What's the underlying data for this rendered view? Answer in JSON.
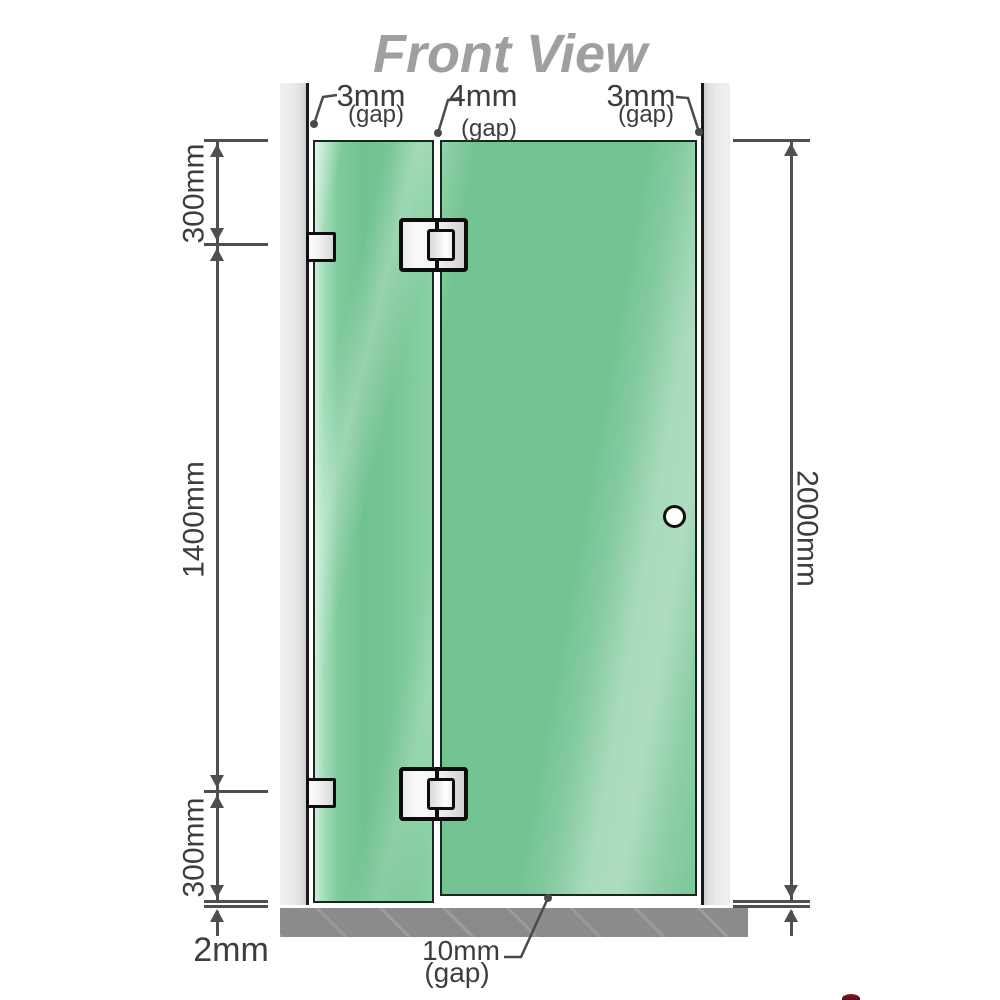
{
  "title": "Front View",
  "dimensions": {
    "gap_left": {
      "value": "3mm",
      "suffix": "(gap)"
    },
    "gap_mid": {
      "value": "4mm",
      "suffix": "(gap)"
    },
    "gap_right": {
      "value": "3mm",
      "suffix": "(gap)"
    },
    "seg_top": "300mm",
    "seg_mid": "1400mm",
    "seg_bottom": "300mm",
    "overall": "2000mm",
    "floor_clearance": "2mm",
    "bottom_gap": {
      "value": "10mm",
      "suffix": "(gap)"
    }
  },
  "colors": {
    "glass": "#74c493",
    "glass_highlight": "#9edcb6",
    "wall_channel": "#eaeaea",
    "floor_base": "#8b8b8b",
    "dimension_line": "#4f4f4f",
    "label_text": "#3d3d3d",
    "title_text": "#9f9f9f",
    "hardware": "#f2f2f2",
    "outline": "#0d0d0d"
  }
}
